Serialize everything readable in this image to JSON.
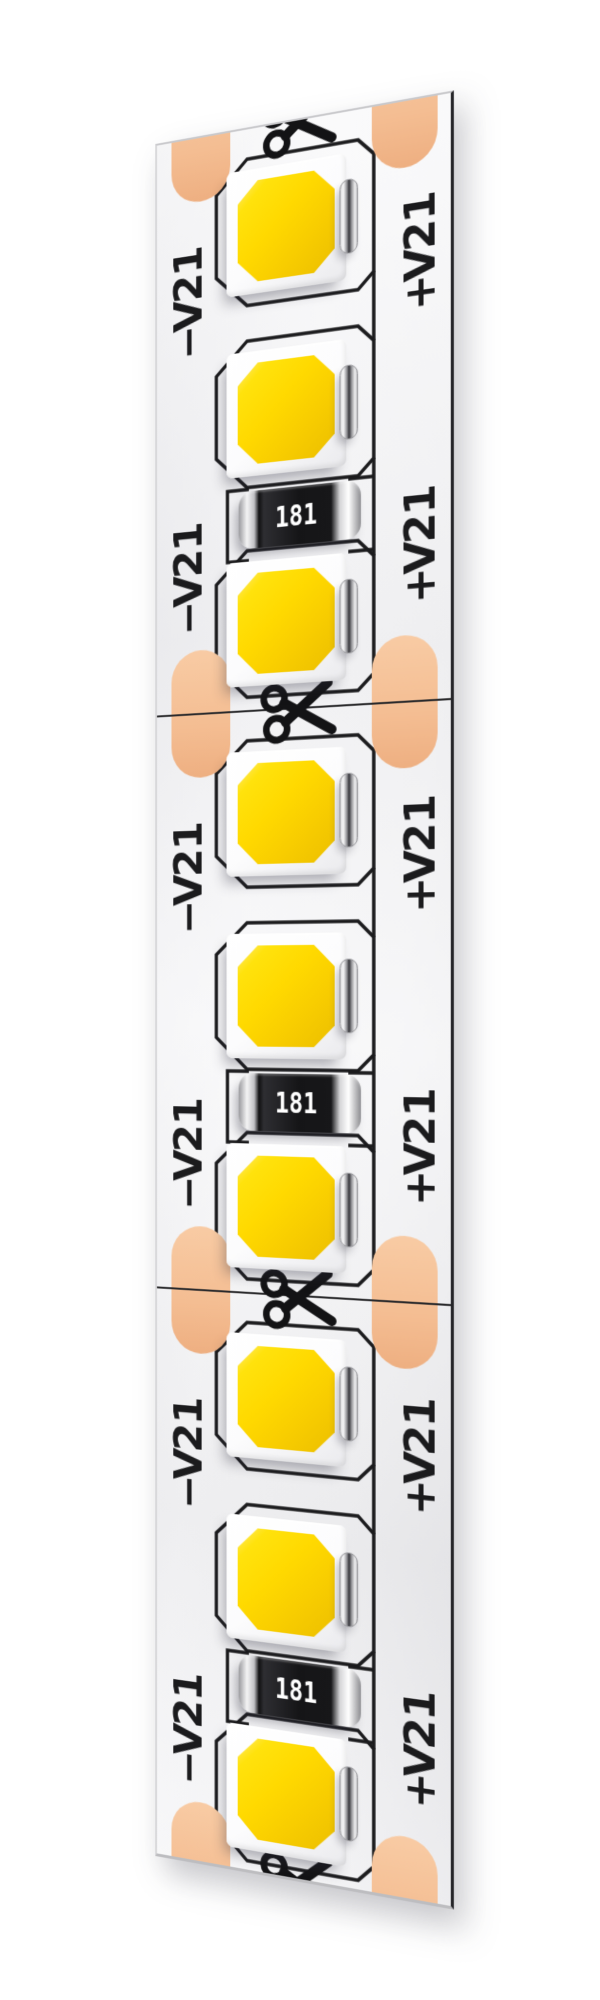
{
  "strip": {
    "description_visible": "white flexible LED strip, 3 cuttable segments",
    "segment_count": 3,
    "leds_per_segment": 3
  },
  "labels": {
    "negative": "12V−",
    "positive": "12V+"
  },
  "segments": [
    {
      "resistor_value": "181",
      "label_negative": "12V−",
      "label_positive": "12V+"
    },
    {
      "resistor_value": "181",
      "label_negative": "12V−",
      "label_positive": "12V+"
    },
    {
      "resistor_value": "181",
      "label_negative": "12V−",
      "label_positive": "12V+"
    }
  ],
  "icons": {
    "cut_marker": "scissors-icon",
    "cut_marker_count": 4
  },
  "colors": {
    "solder_pad_copper": "#F5C096",
    "led_phosphor_yellow": "#FFD900",
    "silkscreen_black": "#1B1B1D",
    "strip_surface": "#F3F3F5",
    "resistor_body": "#161618",
    "resistor_text": "#FFFFFF",
    "contact_silver": "#9A9A9E"
  }
}
